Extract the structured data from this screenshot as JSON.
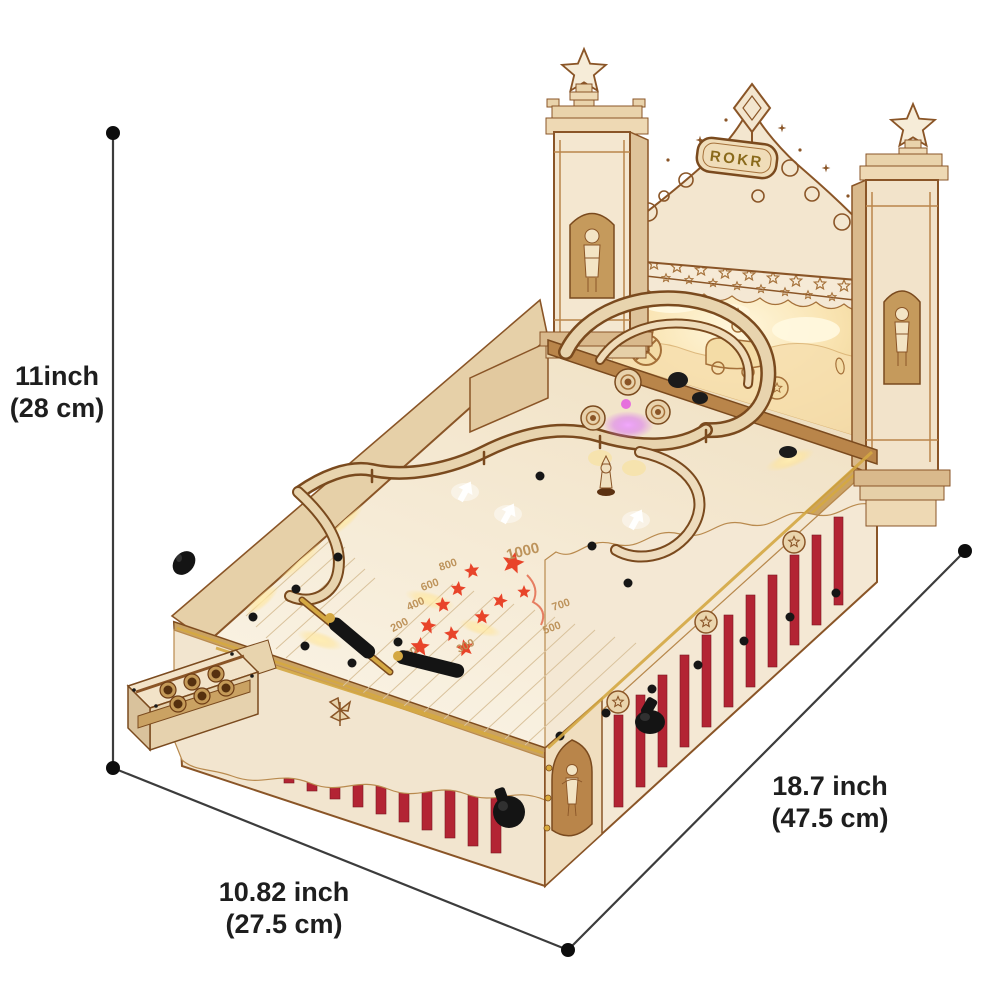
{
  "brand": {
    "plaque_label": "ROKR"
  },
  "dimension_labels": {
    "height": {
      "line1": "11inch",
      "line2": "(28 cm)"
    },
    "width_front": {
      "line1": "10.82 inch",
      "line2": "(27.5 cm)"
    },
    "length_side": {
      "line1": "18.7 inch",
      "line2": "(47.5 cm)"
    }
  },
  "playfield": {
    "scores_outer": [
      "1000",
      "800",
      "600",
      "400",
      "200",
      "100"
    ],
    "scores_inner": [
      "700",
      "500",
      "300"
    ]
  },
  "colors": {
    "background": "#ffffff",
    "wood_light": "#f4e8d4",
    "wood_mid": "#e3cda5",
    "wood_tan": "#caa263",
    "wood_dark": "#8a5527",
    "outline_brown": "#7a4a1e",
    "curtain_red": "#b32434",
    "star_red": "#e8442a",
    "brass_gold": "#d4a843",
    "glow_warm": "#ffe9b0",
    "led_purple": "#d966f0",
    "black_parts": "#161616",
    "dimension_line": "#3c3c3c",
    "dimension_text": "#1e1e1e"
  }
}
